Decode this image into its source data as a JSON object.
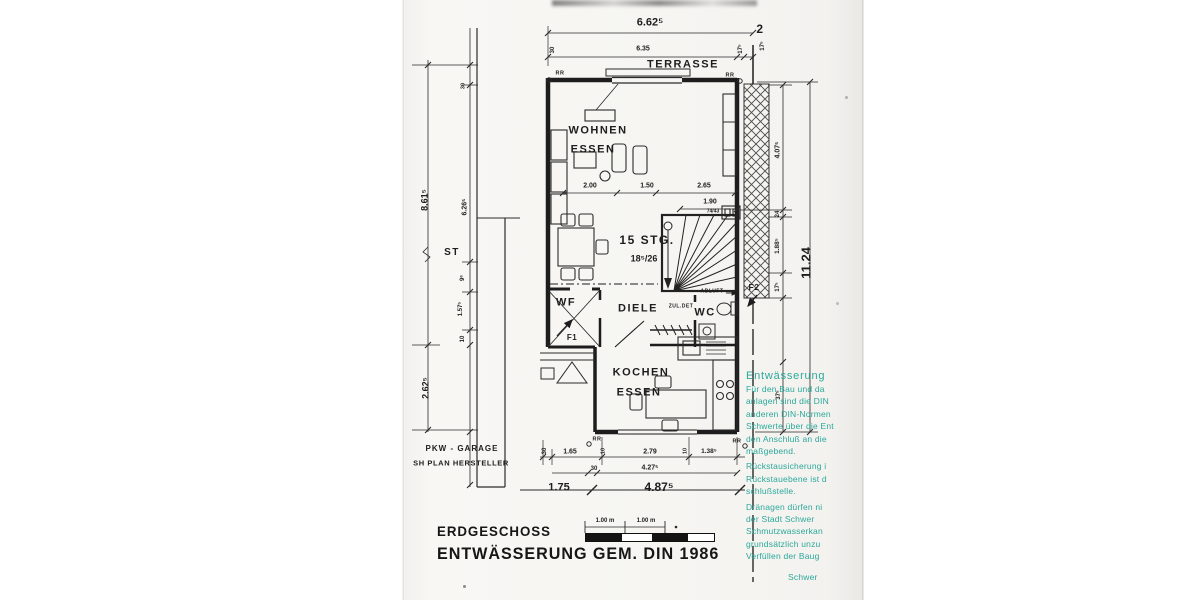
{
  "titles": {
    "floor": "ERDGESCHOSS",
    "drawing": "ENTWÄSSERUNG  GEM. DIN 1986"
  },
  "rooms": {
    "terrasse": "TERRASSE",
    "wohnen": "WOHNEN",
    "essen_wohnen": "ESSEN",
    "stairs": "15 STG.",
    "stairs_sub": "18⁵/26",
    "diele": "DIELE",
    "wf": "WF",
    "wc": "WC",
    "kochen": "KOCHEN",
    "essen_kueche": "ESSEN",
    "st": "ST",
    "garage_line1": "PKW - GARAGE",
    "garage_line2": "SH PLAN HERSTELLER"
  },
  "labels": {
    "boundary_no": "2",
    "rr": "RR",
    "f1": "F1",
    "f2": "F2",
    "abluft": "ABLUFT",
    "zul_det": "ZUL.DET",
    "shaft": "74/43"
  },
  "dims": {
    "top_total": "6.62⁵",
    "top_inner": "6.35",
    "top_left_tick": "30",
    "top_right_1": "17⁵",
    "top_right_2": "17⁵",
    "living_1": "2.00",
    "living_2": "1.50",
    "living_3": "2.65",
    "stair_width": "1.90",
    "right_1": "4.07⁵",
    "right_2": "24",
    "right_3": "1.88⁵",
    "right_4": "17⁵",
    "right_5": "37⁵",
    "right_total": "11.24",
    "left_total": "8.61⁵",
    "left_1": "6.26⁵",
    "left_2": "30",
    "left_3": "9⁶",
    "left_4": "1.57⁵",
    "left_5": "10",
    "left_garage": "2.62⁵",
    "bot_1": "30",
    "bot_2": "1.65",
    "bot_3": "10",
    "bot_4": "2.79",
    "bot_5": "10",
    "bot_6": "1.38⁵",
    "bot_7": "30",
    "bot_8": "4.27⁵",
    "bot_9": "1.75",
    "bot_10": "4.87⁵"
  },
  "scale_bar": {
    "seg1": "1.00 m",
    "seg2": "1.00 m"
  },
  "stamp": {
    "lines": [
      "Entwässerung",
      "Für den Bau und da",
      "anlagen sind die DIN",
      "anderen DIN-Normen",
      "Schwerte über die Ent",
      "den Anschluß an die",
      "maßgebend.",
      "Rückstausicherung i",
      "Rückstauebene ist d",
      "schlußstelle.",
      "Dränagen dürfen ni",
      "der Stadt Schwer",
      "Schmutzwasserkan",
      "grundsätzlich unzu",
      "Verfüllen der Baug",
      "Schwer"
    ]
  }
}
